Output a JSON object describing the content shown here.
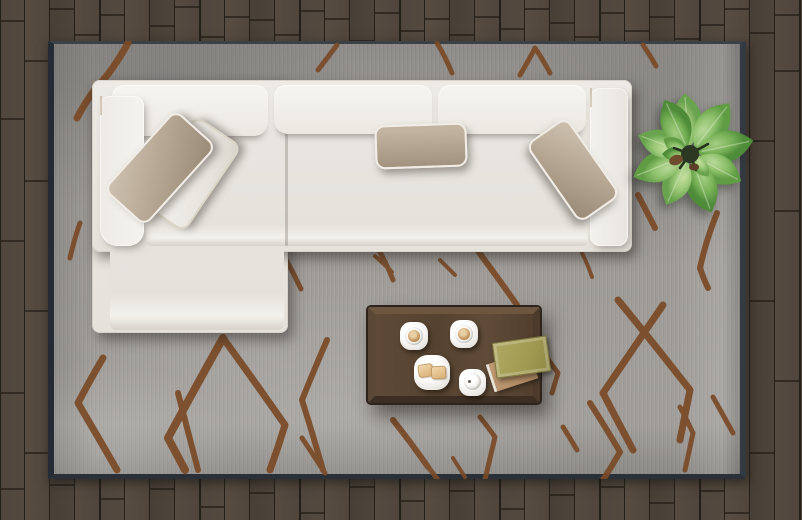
{
  "scene": {
    "name": "living-room-top-view",
    "style": "photorealistic top-down render, no text or UI controls",
    "objects": [
      "wood-floor",
      "area-rug",
      "sectional-sofa",
      "throw-pillows",
      "coffee-table",
      "espresso-cups",
      "snack-plate",
      "lidded-cup",
      "books",
      "potted-plant"
    ]
  },
  "palette": {
    "floor_wood": "#4f463d",
    "floor_gap": "#251f19",
    "rug_gray": "#9c9995",
    "rug_border": "#242b34",
    "rug_pattern_brown": "#7a4a26",
    "sofa_cream": "#efece7",
    "pillow_taupe": "#b2a38f",
    "pillow_white": "#f1efe9",
    "table_wood": "#55422f",
    "table_frame": "#433426",
    "book_olive": "#a09a52",
    "book_tan": "#b5916b",
    "plant_green": "#7fb65d",
    "plant_center": "#2d3823",
    "coffee_brown": "#c3945c",
    "toast_tan": "#e3c18b"
  },
  "counts": {
    "sofa_back_cushions": 3,
    "throw_pillows": 4,
    "cups_on_table": 3,
    "plates_on_table": 1,
    "books_on_table": 2,
    "plants": 1
  }
}
